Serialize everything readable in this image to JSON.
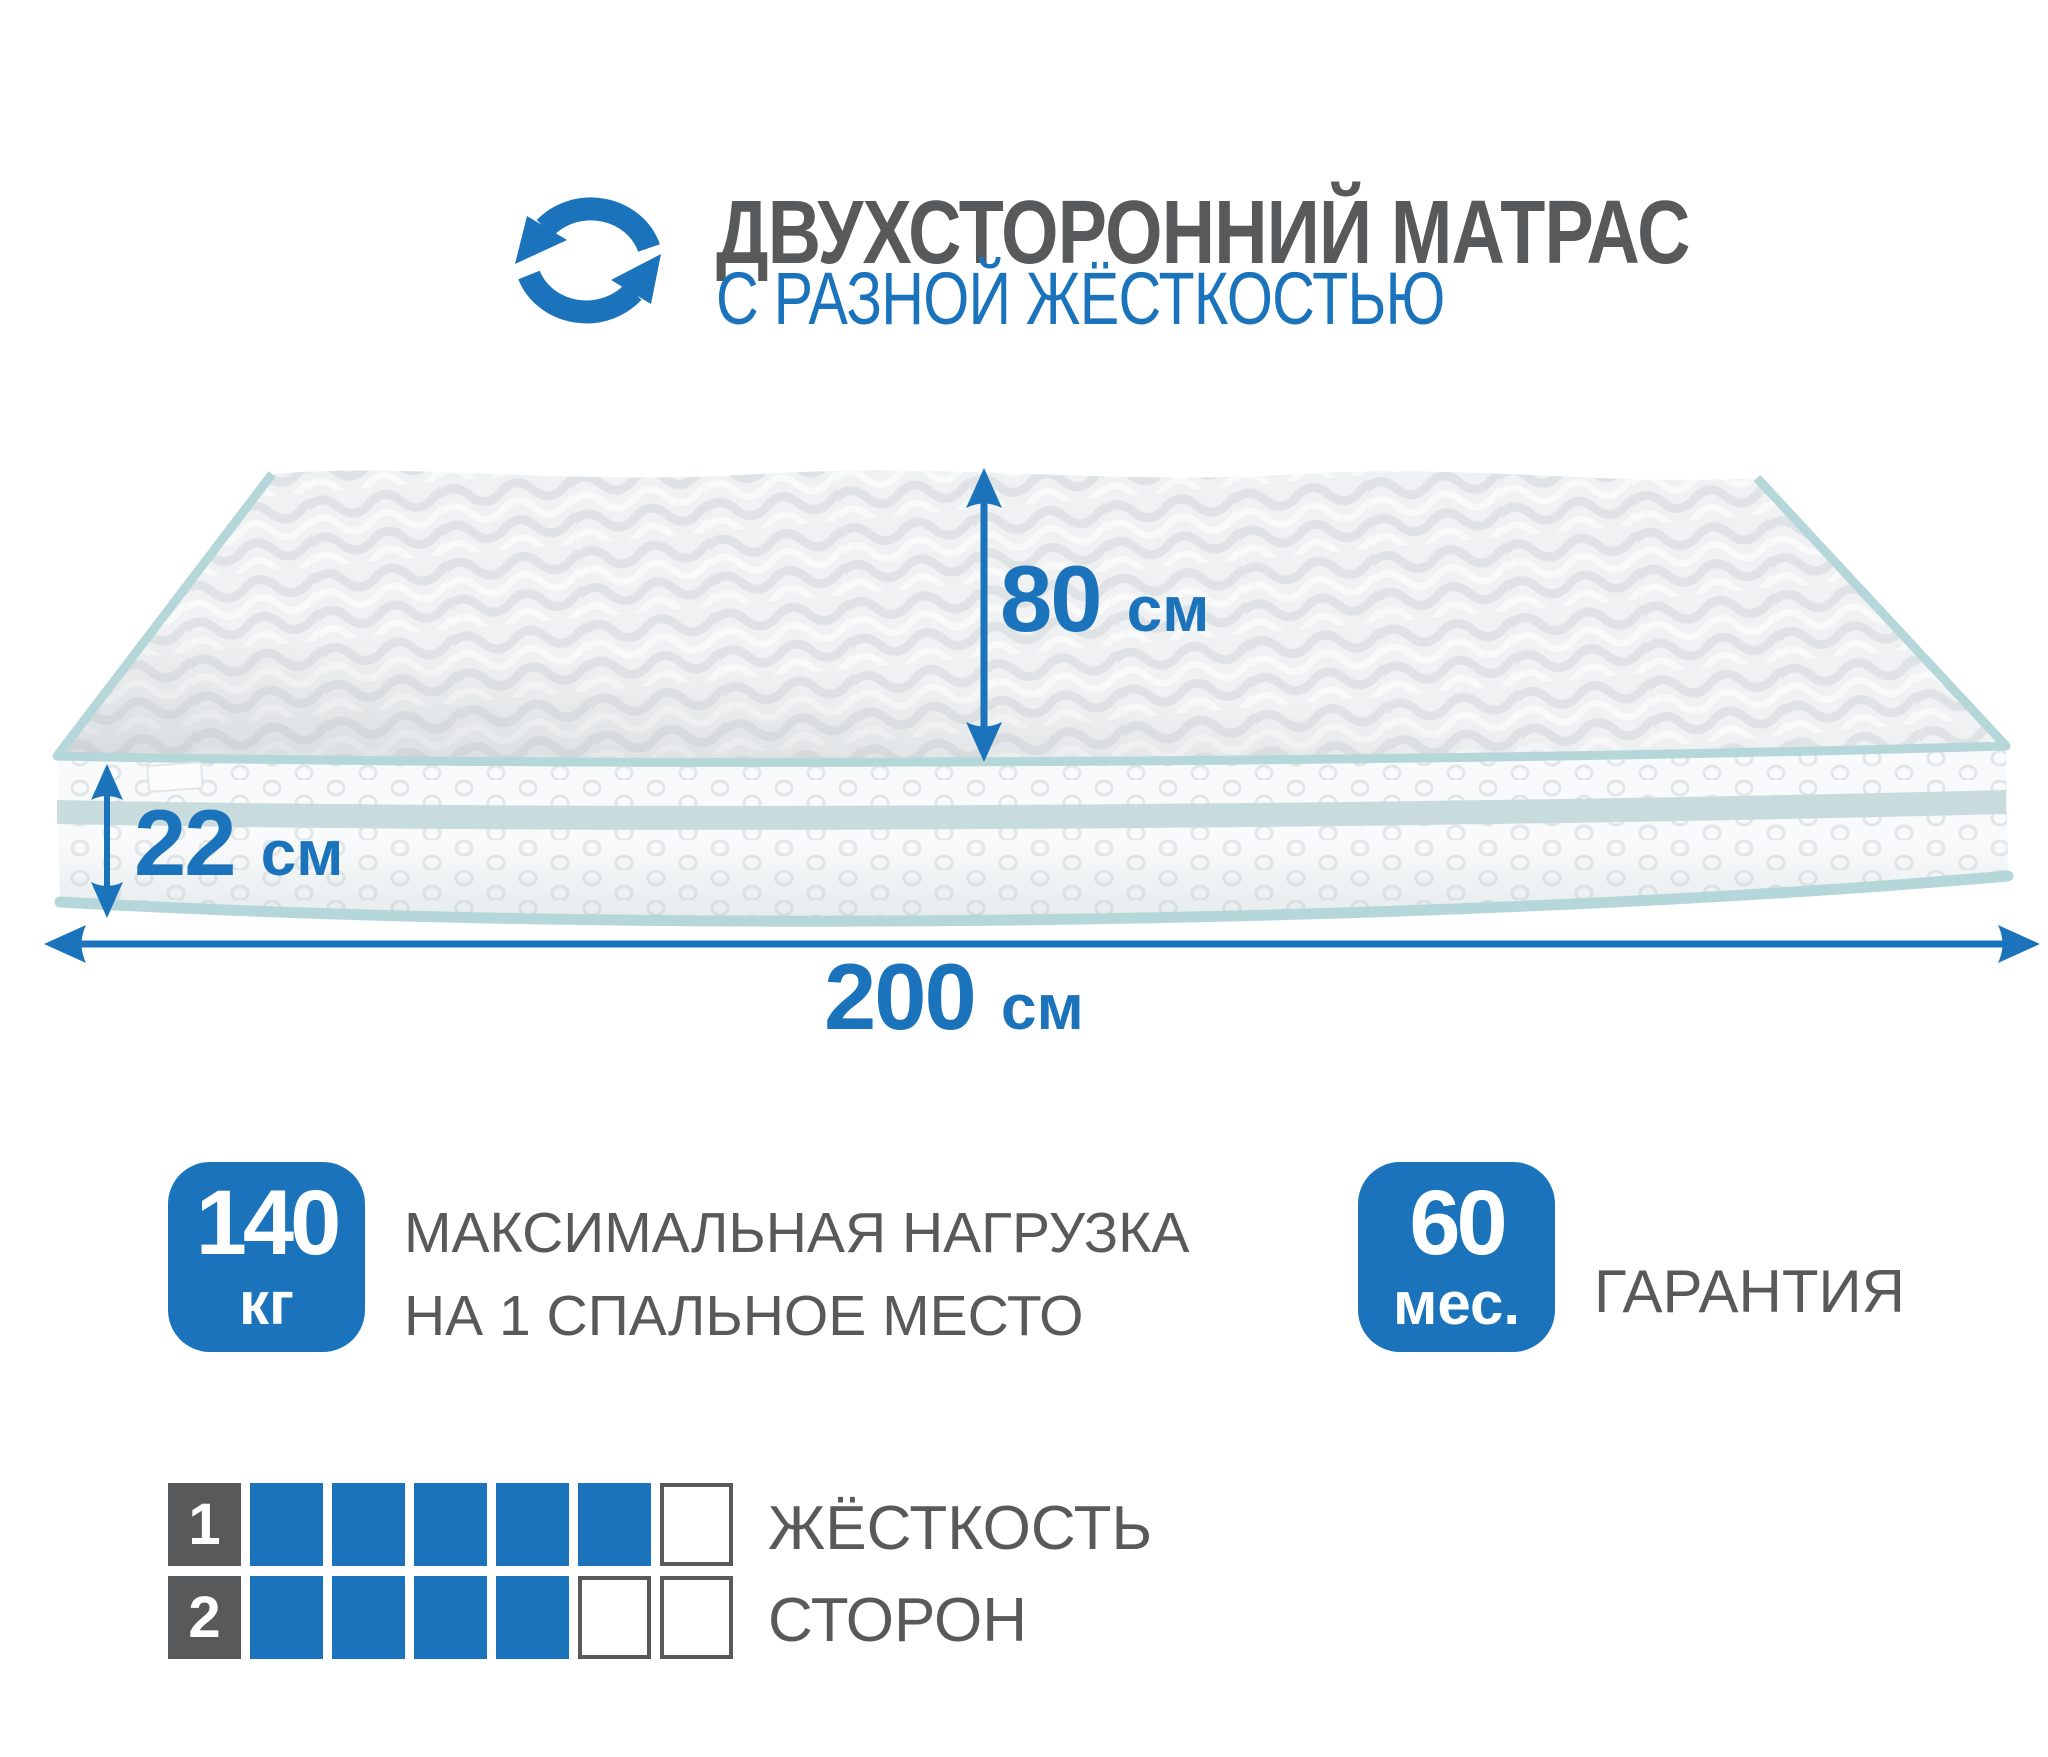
{
  "header": {
    "icon": "rotate-arrows-icon",
    "title": "ДВУХСТОРОННИЙ МАТРАС",
    "subtitle": "С РАЗНОЙ ЖЁСТКОСТЬЮ"
  },
  "dimensions": {
    "sleeping_width": {
      "value": "80",
      "unit": "см"
    },
    "mattress_height": {
      "value": "22",
      "unit": "см"
    },
    "mattress_length": {
      "value": "200",
      "unit": "см"
    }
  },
  "max_load": {
    "value": "140",
    "unit": "кг",
    "label_line1": "МАКСИМАЛЬНАЯ НАГРУЗКА",
    "label_line2": "НА 1 СПАЛЬНОЕ МЕСТО"
  },
  "warranty": {
    "value": "60",
    "unit": "мес.",
    "label": "ГАРАНТИЯ"
  },
  "firmness": {
    "label_line1": "ЖЁСТКОСТЬ",
    "label_line2": "СТОРОН",
    "scale_max": 6,
    "rows": [
      {
        "side": "1",
        "filled": 5
      },
      {
        "side": "2",
        "filled": 4
      }
    ]
  },
  "colors": {
    "accent_blue": "#1b74bb",
    "text_gray": "#58595b",
    "piping_teal": "#b6d7d9"
  }
}
